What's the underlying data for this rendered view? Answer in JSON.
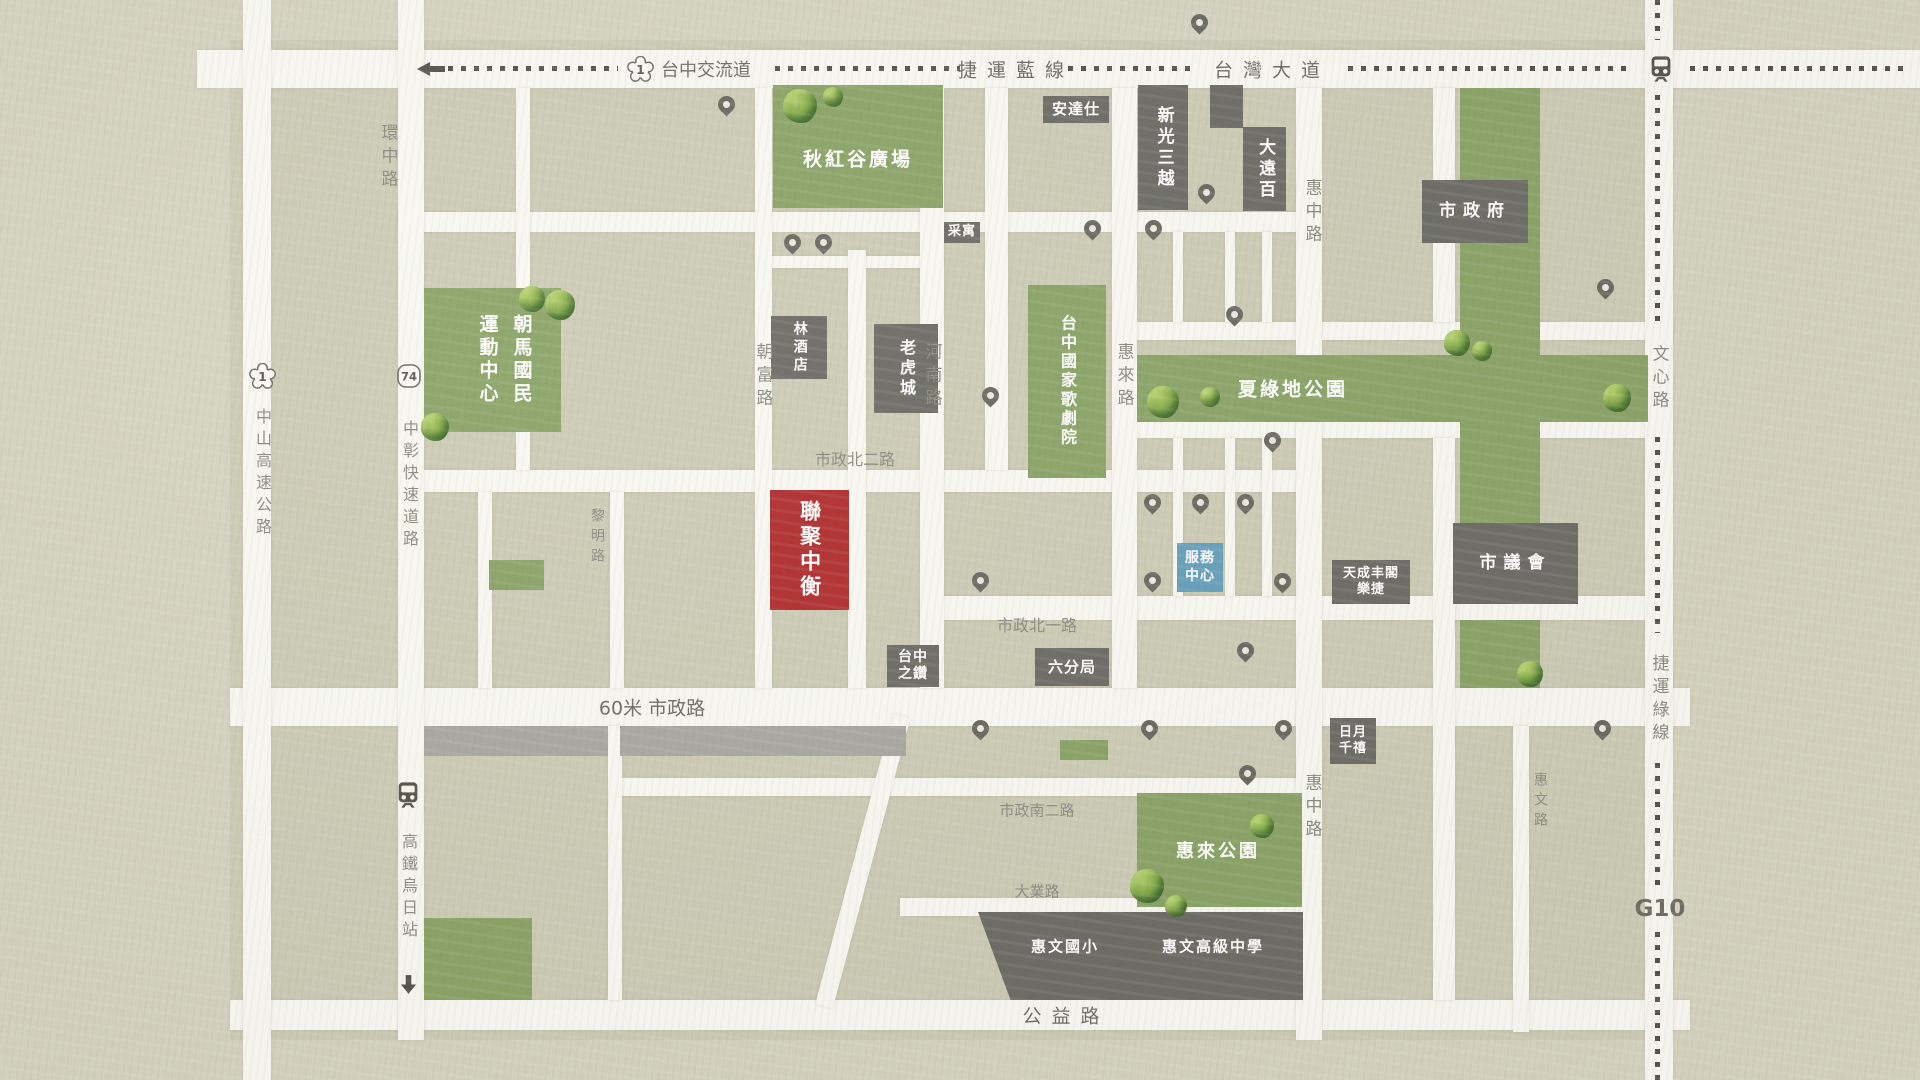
{
  "map": {
    "colors": {
      "background": "#d6d4c1",
      "urban_block": "#cdccb6",
      "road": "#f9f8f2",
      "park_green": "#8ca468",
      "building_gray": "#6e6d67",
      "highlight_red": "#b13030",
      "service_blue": "#68a0bd",
      "gray_strip": "#a9a8a3",
      "label_gray": "#8c8c83",
      "dash_dark": "#55554e"
    },
    "urban": {
      "x": 230,
      "y": 40,
      "w": 1442,
      "h": 1000
    },
    "roads": [
      {
        "id": "taiwan-boulevard",
        "x": 197,
        "y": 50,
        "w": 1723,
        "h": 38
      },
      {
        "id": "north-sub-road",
        "x": 398,
        "y": 212,
        "w": 924,
        "h": 20
      },
      {
        "id": "qiuhonggu-south-lane",
        "x": 756,
        "y": 256,
        "w": 188,
        "h": 12
      },
      {
        "id": "shizheng-north-2nd-rd",
        "x": 424,
        "y": 470,
        "w": 898,
        "h": 22
      },
      {
        "id": "shizheng-north-1st-rd",
        "x": 920,
        "y": 596,
        "w": 728,
        "h": 24
      },
      {
        "id": "shizheng-road",
        "x": 230,
        "y": 688,
        "w": 1460,
        "h": 38
      },
      {
        "id": "shizheng-south-2nd-rd",
        "x": 610,
        "y": 778,
        "w": 712,
        "h": 18
      },
      {
        "id": "daye-road",
        "x": 900,
        "y": 898,
        "w": 422,
        "h": 18
      },
      {
        "id": "gongyi-road",
        "x": 230,
        "y": 1000,
        "w": 1460,
        "h": 30
      },
      {
        "id": "park-top-road-west",
        "x": 1120,
        "y": 322,
        "w": 345,
        "h": 18
      },
      {
        "id": "park-top-road-east",
        "x": 1537,
        "y": 322,
        "w": 135,
        "h": 18
      },
      {
        "id": "park-bottom-road-west",
        "x": 1120,
        "y": 420,
        "w": 345,
        "h": 18
      },
      {
        "id": "park-bottom-road-east",
        "x": 1537,
        "y": 420,
        "w": 135,
        "h": 18
      },
      {
        "id": "zhongshan-highway",
        "x": 243,
        "y": 0,
        "w": 28,
        "h": 1080
      },
      {
        "id": "huanzhong-corridor",
        "x": 398,
        "y": 0,
        "w": 26,
        "h": 1040
      },
      {
        "id": "upper-left-lane",
        "x": 516,
        "y": 88,
        "w": 14,
        "h": 382
      },
      {
        "id": "lower-left-lane",
        "x": 478,
        "y": 492,
        "w": 14,
        "h": 196
      },
      {
        "id": "liming-road",
        "x": 610,
        "y": 492,
        "w": 14,
        "h": 196
      },
      {
        "id": "liming-road-south",
        "x": 608,
        "y": 726,
        "w": 14,
        "h": 274
      },
      {
        "id": "chaofu-road",
        "x": 755,
        "y": 88,
        "w": 17,
        "h": 600
      },
      {
        "id": "center-lane",
        "x": 848,
        "y": 250,
        "w": 18,
        "h": 438
      },
      {
        "id": "henan-road",
        "x": 920,
        "y": 88,
        "w": 24,
        "h": 600
      },
      {
        "id": "lane-opera-west",
        "x": 985,
        "y": 88,
        "w": 23,
        "h": 382
      },
      {
        "id": "huilai-road",
        "x": 1112,
        "y": 88,
        "w": 25,
        "h": 600
      },
      {
        "id": "lane-a-north",
        "x": 1173,
        "y": 232,
        "w": 10,
        "h": 90
      },
      {
        "id": "lane-b-north",
        "x": 1225,
        "y": 232,
        "w": 10,
        "h": 90
      },
      {
        "id": "lane-c-north",
        "x": 1262,
        "y": 232,
        "w": 10,
        "h": 90
      },
      {
        "id": "lane-a-south",
        "x": 1173,
        "y": 438,
        "w": 10,
        "h": 158
      },
      {
        "id": "lane-b-south",
        "x": 1225,
        "y": 438,
        "w": 10,
        "h": 158
      },
      {
        "id": "lane-c-south",
        "x": 1262,
        "y": 438,
        "w": 10,
        "h": 158
      },
      {
        "id": "huizhong-road-north",
        "x": 1296,
        "y": 88,
        "w": 26,
        "h": 267
      },
      {
        "id": "huizhong-road-south",
        "x": 1296,
        "y": 422,
        "w": 26,
        "h": 618
      },
      {
        "id": "council-west-lane-north",
        "x": 1433,
        "y": 88,
        "w": 22,
        "h": 234
      },
      {
        "id": "council-west-lane-south",
        "x": 1433,
        "y": 438,
        "w": 22,
        "h": 562
      },
      {
        "id": "huiwen-road",
        "x": 1513,
        "y": 726,
        "w": 16,
        "h": 306
      },
      {
        "id": "wenxin-road",
        "x": 1645,
        "y": 0,
        "w": 28,
        "h": 1080
      }
    ],
    "curved_road": {
      "x": 893,
      "y": 714,
      "w": 18,
      "h": 300,
      "rot": 15
    },
    "roads_over": [
      {
        "x": 1460,
        "y": 596,
        "w": 80,
        "h": 24
      }
    ],
    "gray_strips": [
      {
        "x": 424,
        "y": 726,
        "w": 184,
        "h": 30
      },
      {
        "x": 620,
        "y": 726,
        "w": 286,
        "h": 30
      }
    ],
    "parks": [
      {
        "name": "qiuhonggu-plaza",
        "label": "秋紅谷廣場",
        "x": 773,
        "y": 85,
        "w": 170,
        "h": 123,
        "lx": 858,
        "ly": 158,
        "ls": 19
      },
      {
        "name": "chaoma-sports-center",
        "label": [
          "朝馬國民",
          "運動中心"
        ],
        "cols": true,
        "x": 424,
        "y": 288,
        "w": 137,
        "h": 144,
        "lx": 505,
        "ly": 360,
        "ls": 19
      },
      {
        "name": "taichung-opera-house",
        "label": "台中國家歌劇院",
        "vert": true,
        "x": 1028,
        "y": 285,
        "w": 78,
        "h": 193,
        "lx": 1067,
        "ly": 381,
        "ls": 16
      },
      {
        "name": "xialvdi-park",
        "label": "夏綠地公園",
        "x": 1137,
        "y": 355,
        "w": 511,
        "h": 67,
        "lx": 1293,
        "ly": 388,
        "ls": 19
      },
      {
        "name": "green-strip",
        "label": "",
        "x": 1460,
        "y": 88,
        "w": 80,
        "h": 600
      },
      {
        "name": "huilai-park",
        "label": "惠來公園",
        "x": 1137,
        "y": 793,
        "w": 165,
        "h": 114,
        "lx": 1218,
        "ly": 850,
        "ls": 18
      }
    ],
    "green_patches": [
      {
        "x": 489,
        "y": 560,
        "w": 55,
        "h": 30
      },
      {
        "x": 424,
        "y": 918,
        "w": 108,
        "h": 82
      },
      {
        "x": 1060,
        "y": 740,
        "w": 48,
        "h": 20
      }
    ],
    "buildings": [
      {
        "name": "andaz-hotel",
        "label": "安達仕",
        "x": 1043,
        "y": 96,
        "w": 66,
        "h": 27,
        "s": 15
      },
      {
        "name": "shinkong-mitsukoshi",
        "label": "新光三越",
        "x": 1138,
        "y": 85,
        "w": 50,
        "h": 125,
        "o": "v",
        "s": 17
      },
      {
        "name": "annex-block",
        "label": "",
        "x": 1210,
        "y": 85,
        "w": 33,
        "h": 43
      },
      {
        "name": "top-city",
        "label": "大遠百",
        "x": 1243,
        "y": 127,
        "w": 43,
        "h": 84,
        "o": "v",
        "s": 17
      },
      {
        "name": "city-hall",
        "label": "市政府",
        "x": 1422,
        "y": 180,
        "w": 106,
        "h": 63,
        "s": 17,
        "sp": true
      },
      {
        "name": "caiyu",
        "label": "采寓",
        "x": 944,
        "y": 222,
        "w": 36,
        "h": 21,
        "s": 13
      },
      {
        "name": "lin-hotel",
        "label": "林酒店",
        "x": 771,
        "y": 316,
        "w": 56,
        "h": 63,
        "o": "v",
        "s": 14
      },
      {
        "name": "tiger-city",
        "label": "老虎城",
        "x": 874,
        "y": 324,
        "w": 64,
        "h": 89,
        "o": "v",
        "s": 16
      },
      {
        "name": "lianju-zhongheng",
        "label": "聯聚中衡",
        "x": 770,
        "y": 490,
        "w": 79,
        "h": 120,
        "o": "v",
        "s": 21,
        "t": "highlight"
      },
      {
        "name": "service-center",
        "label": [
          "服務",
          "中心"
        ],
        "x": 1177,
        "y": 543,
        "w": 46,
        "h": 49,
        "s": 14,
        "t": "service"
      },
      {
        "name": "tiancheng-fengge-leijie",
        "label": [
          "天成丰閣",
          "樂捷"
        ],
        "x": 1332,
        "y": 560,
        "w": 78,
        "h": 44,
        "s": 13
      },
      {
        "name": "city-council",
        "label": "市議會",
        "x": 1453,
        "y": 523,
        "w": 125,
        "h": 81,
        "s": 17,
        "sp": true
      },
      {
        "name": "taichung-diamond",
        "label": [
          "台中",
          "之鑽"
        ],
        "x": 887,
        "y": 645,
        "w": 52,
        "h": 42,
        "s": 14
      },
      {
        "name": "sixth-precinct",
        "label": "六分局",
        "x": 1035,
        "y": 648,
        "w": 74,
        "h": 38,
        "s": 15
      },
      {
        "name": "millennium-hotel",
        "label": [
          "日月",
          "千禧"
        ],
        "x": 1330,
        "y": 718,
        "w": 46,
        "h": 46,
        "s": 13
      },
      {
        "name": "huiwen-school-block",
        "label": "",
        "x": 978,
        "y": 912,
        "w": 325,
        "h": 88,
        "clip": true
      }
    ],
    "building_labels": [
      {
        "text": "惠文國小",
        "x": 1065,
        "y": 946,
        "s": 15
      },
      {
        "text": "惠文高級中學",
        "x": 1213,
        "y": 946,
        "s": 15
      }
    ],
    "road_labels": [
      {
        "text": "台中交流道",
        "x": 706,
        "y": 69,
        "o": "h",
        "s": 18,
        "dark": true
      },
      {
        "text": "捷運藍線",
        "x": 1016,
        "y": 69,
        "o": "h",
        "s": 19,
        "dark": true,
        "sp": true
      },
      {
        "text": "台灣大道",
        "x": 1272,
        "y": 69,
        "o": "h",
        "s": 19,
        "dark": true,
        "sp": true
      },
      {
        "text": "環中路",
        "x": 388,
        "y": 158,
        "o": "v",
        "s": 17
      },
      {
        "text": "中山高速公路",
        "x": 262,
        "y": 474,
        "o": "v",
        "s": 16
      },
      {
        "text": "中彰快速道路",
        "x": 409,
        "y": 486,
        "o": "v",
        "s": 16
      },
      {
        "text": "高鐵烏日站",
        "x": 408,
        "y": 888,
        "o": "v",
        "s": 16
      },
      {
        "text": "黎明路",
        "x": 597,
        "y": 538,
        "o": "v",
        "s": 14
      },
      {
        "text": "朝富路",
        "x": 763,
        "y": 377,
        "o": "v",
        "s": 17
      },
      {
        "text": "河南路",
        "x": 932,
        "y": 377,
        "o": "v",
        "s": 17
      },
      {
        "text": "惠來路",
        "x": 1124,
        "y": 377,
        "o": "v",
        "s": 17
      },
      {
        "text": "惠中路",
        "x": 1312,
        "y": 213,
        "o": "v",
        "s": 17
      },
      {
        "text": "惠中路",
        "x": 1312,
        "y": 808,
        "o": "v",
        "s": 17
      },
      {
        "text": "惠文路",
        "x": 1540,
        "y": 802,
        "o": "v",
        "s": 14
      },
      {
        "text": "文心路",
        "x": 1659,
        "y": 379,
        "o": "v",
        "s": 17
      },
      {
        "text": "捷運綠線",
        "x": 1659,
        "y": 700,
        "o": "v",
        "s": 17
      },
      {
        "text": "市政北二路",
        "x": 855,
        "y": 458,
        "o": "h",
        "s": 16
      },
      {
        "text": "市政北一路",
        "x": 1037,
        "y": 624,
        "o": "h",
        "s": 16
      },
      {
        "text": "60米 市政路",
        "x": 652,
        "y": 707,
        "o": "h",
        "s": 19,
        "dark": true
      },
      {
        "text": "市政南二路",
        "x": 1037,
        "y": 810,
        "o": "h",
        "s": 15
      },
      {
        "text": "大業路",
        "x": 1037,
        "y": 891,
        "o": "h",
        "s": 15
      },
      {
        "text": "公益路",
        "x": 1066,
        "y": 1015,
        "o": "h",
        "s": 19,
        "dark": true,
        "sp": true
      },
      {
        "text": "G10",
        "x": 1660,
        "y": 909,
        "o": "h",
        "s": 23,
        "dark": true,
        "bold": true
      }
    ],
    "transit": {
      "blue_line": {
        "y": 66,
        "segments": [
          [
            448,
            618
          ],
          [
            775,
            960
          ],
          [
            1068,
            1192
          ],
          [
            1348,
            1632
          ],
          [
            1690,
            1910
          ]
        ]
      },
      "green_line": {
        "x": 1655,
        "segments": [
          [
            0,
            40
          ],
          [
            95,
            322
          ],
          [
            437,
            633
          ],
          [
            763,
            888
          ],
          [
            932,
            1080
          ]
        ]
      }
    },
    "shields": [
      {
        "type": "plum",
        "num": "1",
        "x": 640,
        "y": 69
      },
      {
        "type": "plum",
        "num": "1",
        "x": 262,
        "y": 376
      },
      {
        "type": "round",
        "num": "74",
        "x": 409,
        "y": 376
      }
    ],
    "stations": [
      {
        "x": 1661,
        "y": 69
      },
      {
        "x": 408,
        "y": 795
      }
    ],
    "arrows": [
      {
        "x": 431,
        "y": 69,
        "dir": "left"
      },
      {
        "x": 408,
        "y": 984,
        "dir": "down"
      }
    ],
    "pins": [
      [
        1199,
        22
      ],
      [
        726,
        104
      ],
      [
        792,
        242
      ],
      [
        823,
        242
      ],
      [
        1092,
        228
      ],
      [
        1153,
        228
      ],
      [
        1206,
        192
      ],
      [
        1234,
        314
      ],
      [
        1605,
        287
      ],
      [
        990,
        395
      ],
      [
        1152,
        502
      ],
      [
        1200,
        502
      ],
      [
        1245,
        502
      ],
      [
        1272,
        440
      ],
      [
        1152,
        580
      ],
      [
        980,
        580
      ],
      [
        1282,
        581
      ],
      [
        1245,
        650
      ],
      [
        980,
        728
      ],
      [
        1149,
        728
      ],
      [
        1283,
        728
      ],
      [
        1602,
        728
      ],
      [
        1247,
        773
      ]
    ],
    "trees": [
      [
        800,
        106,
        34
      ],
      [
        833,
        97,
        20
      ],
      [
        532,
        299,
        26
      ],
      [
        560,
        305,
        30
      ],
      [
        435,
        427,
        28
      ],
      [
        1163,
        402,
        32
      ],
      [
        1210,
        397,
        20
      ],
      [
        1457,
        343,
        26
      ],
      [
        1482,
        351,
        20
      ],
      [
        1617,
        398,
        28
      ],
      [
        1530,
        674,
        26
      ],
      [
        1147,
        886,
        34
      ],
      [
        1176,
        906,
        22
      ],
      [
        1262,
        826,
        24
      ]
    ]
  }
}
